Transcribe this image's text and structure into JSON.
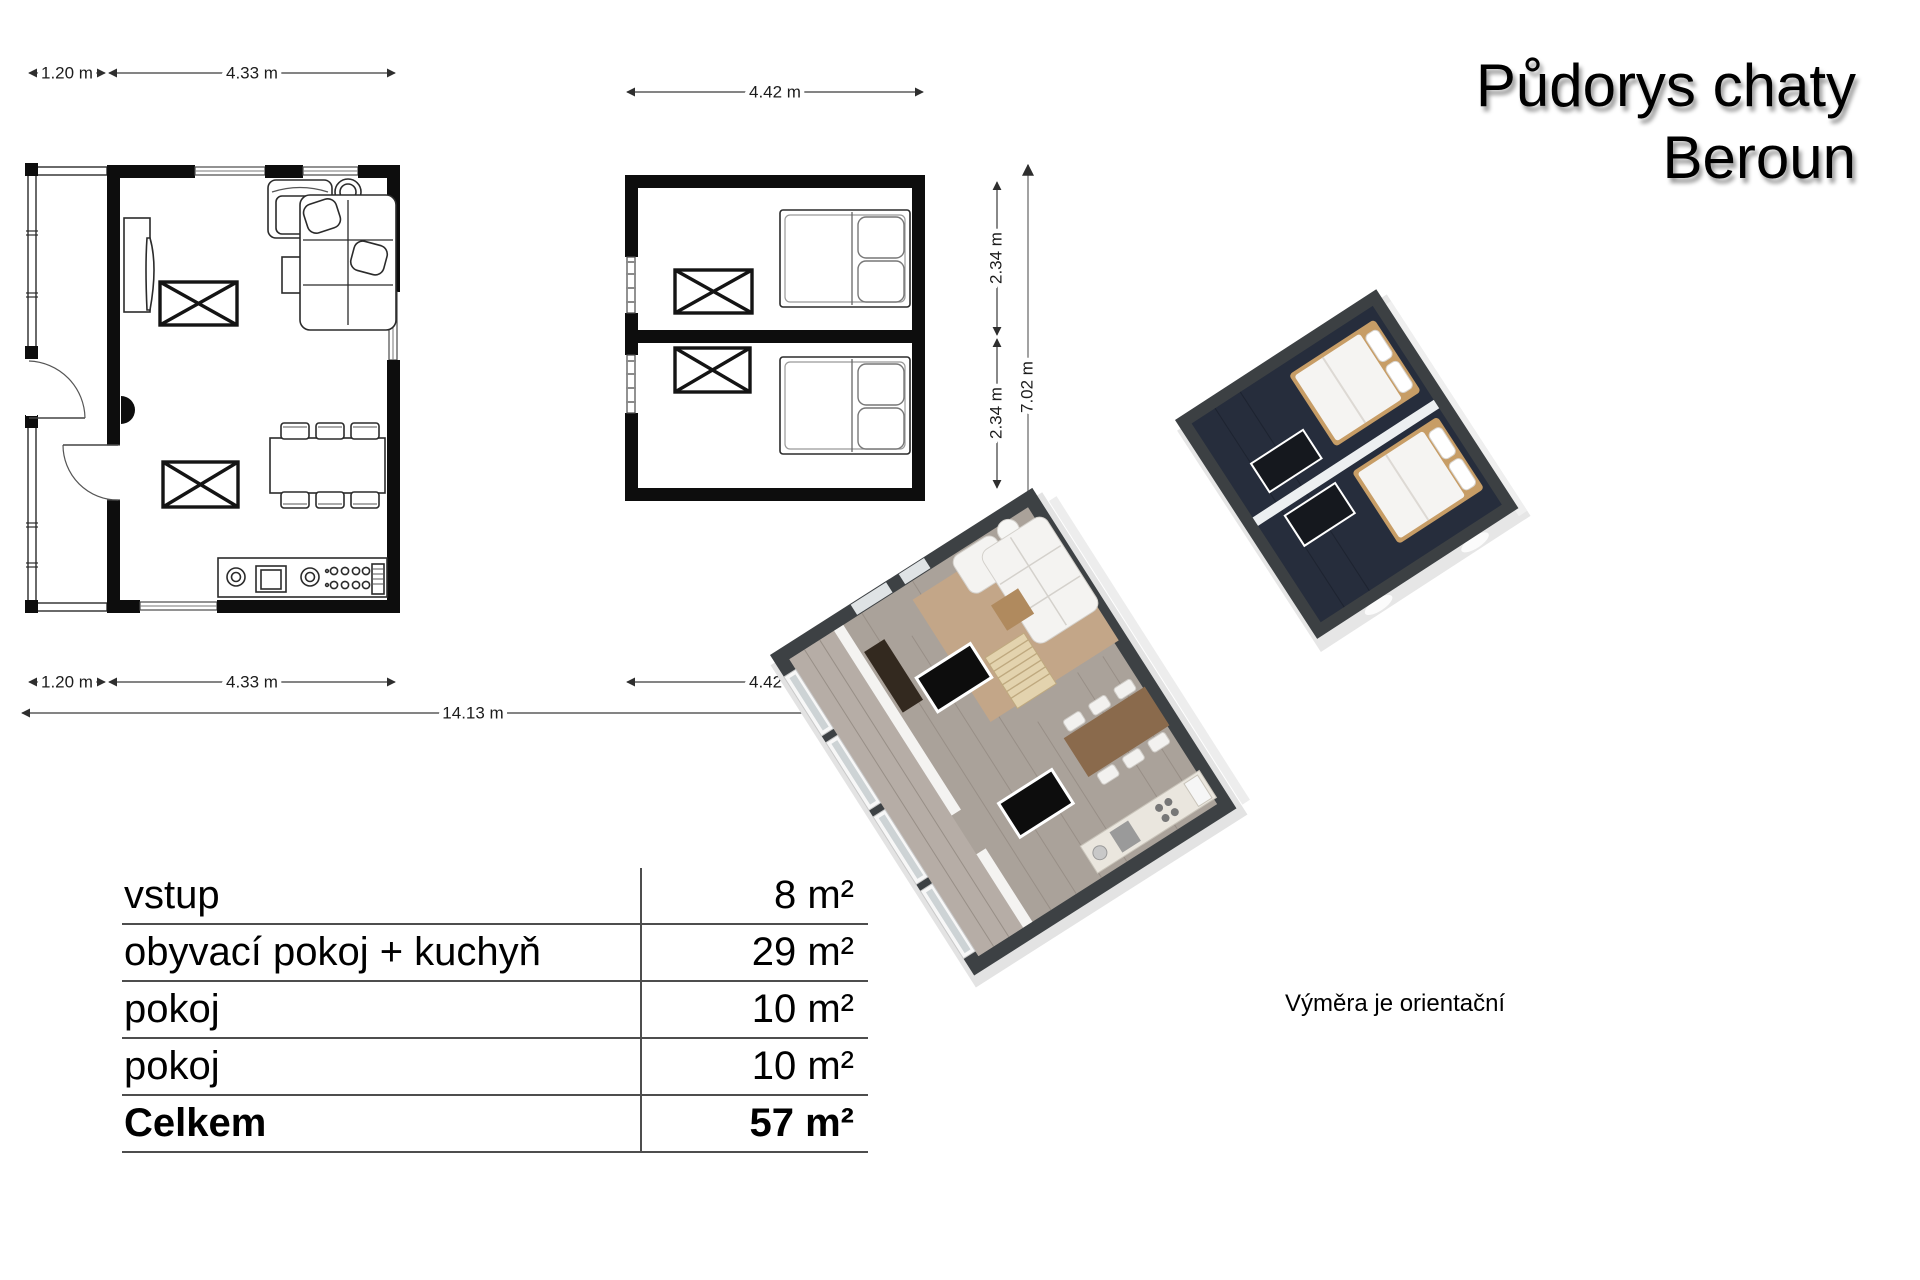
{
  "title": {
    "line1": "Půdorys chaty",
    "line2": "Beroun"
  },
  "footnote": "Výměra je orientační",
  "dimensions": {
    "left_top_porch": "1.20 m",
    "left_top_main": "4.33 m",
    "middle_top": "4.42 m",
    "left_bottom_porch": "1.20 m",
    "left_bottom_main": "4.33 m",
    "middle_bottom": "4.42 m",
    "total_width": "14.13 m",
    "room1_height": "2.34 m",
    "room2_height": "2.34 m",
    "total_height": "7.02 m"
  },
  "area_table": {
    "rows": [
      {
        "label": "vstup",
        "value": "8 m²"
      },
      {
        "label": "obyvací pokoj + kuchyň",
        "value": "29 m²"
      },
      {
        "label": "pokoj",
        "value": "10 m²"
      },
      {
        "label": "pokoj",
        "value": "10 m²"
      }
    ],
    "total": {
      "label": "Celkem",
      "value": "57 m²"
    }
  },
  "colors": {
    "plan_wall": "#0d0d0d",
    "dim_line": "#3a3a3a",
    "table_line": "#4d4d4d",
    "render_wall_top": "#3d4144",
    "render_wall_side": "#e4e4e4",
    "render_wood_floor": "#aaa29a",
    "render_corridor_floor": "#b6ada6",
    "render_rug": "#c3a688",
    "render_bedroom_floor": "#262d3c",
    "render_bed_frame": "#c79d66",
    "render_table_wood": "#8a6a4c"
  }
}
